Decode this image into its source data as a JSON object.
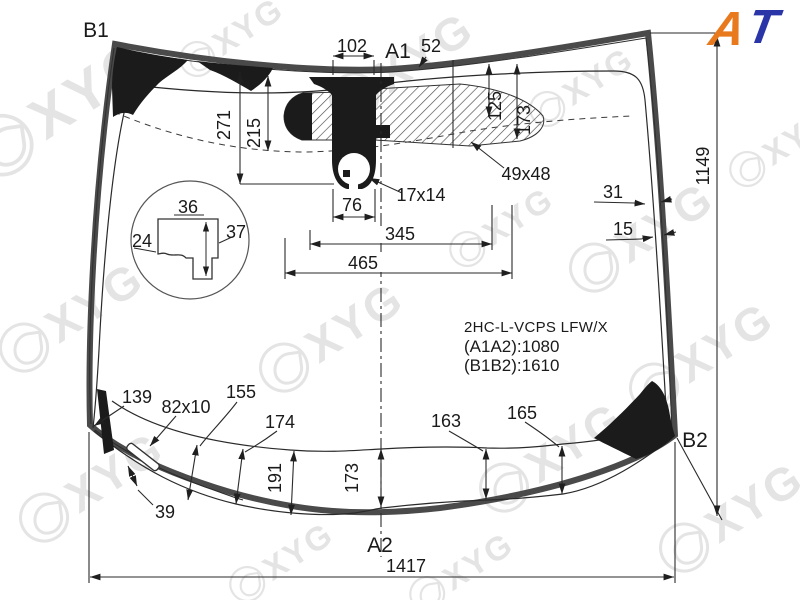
{
  "title_block": {
    "part_code": "2HC-L-VCPS LFW/X",
    "length_a1a2": "(A1A2):1080",
    "length_b1b2": "(B1B2):1610"
  },
  "labels": {
    "b1": "B1",
    "a1": "A1",
    "a2": "A2",
    "b2": "B2"
  },
  "dims": {
    "d102": "102",
    "d52": "52",
    "d271": "271",
    "d215": "215",
    "d125": "125",
    "d173_top": "173",
    "d49x48": "49x48",
    "d17x14": "17x14",
    "d76": "76",
    "d345": "345",
    "d465": "465",
    "d31": "31",
    "d15": "15",
    "d1149": "1149",
    "d36": "36",
    "d37": "37",
    "d24": "24",
    "d139": "139",
    "d82x10": "82x10",
    "d155": "155",
    "d174": "174",
    "d191": "191",
    "d173_bottom": "173",
    "d163": "163",
    "d165": "165",
    "d39": "39",
    "d1417": "1417"
  },
  "watermark": {
    "text": "XYG"
  },
  "logo": {
    "letter_a": "A",
    "letter_t": "T",
    "color_a": "#e8791d",
    "color_t": "#2a35a8"
  }
}
